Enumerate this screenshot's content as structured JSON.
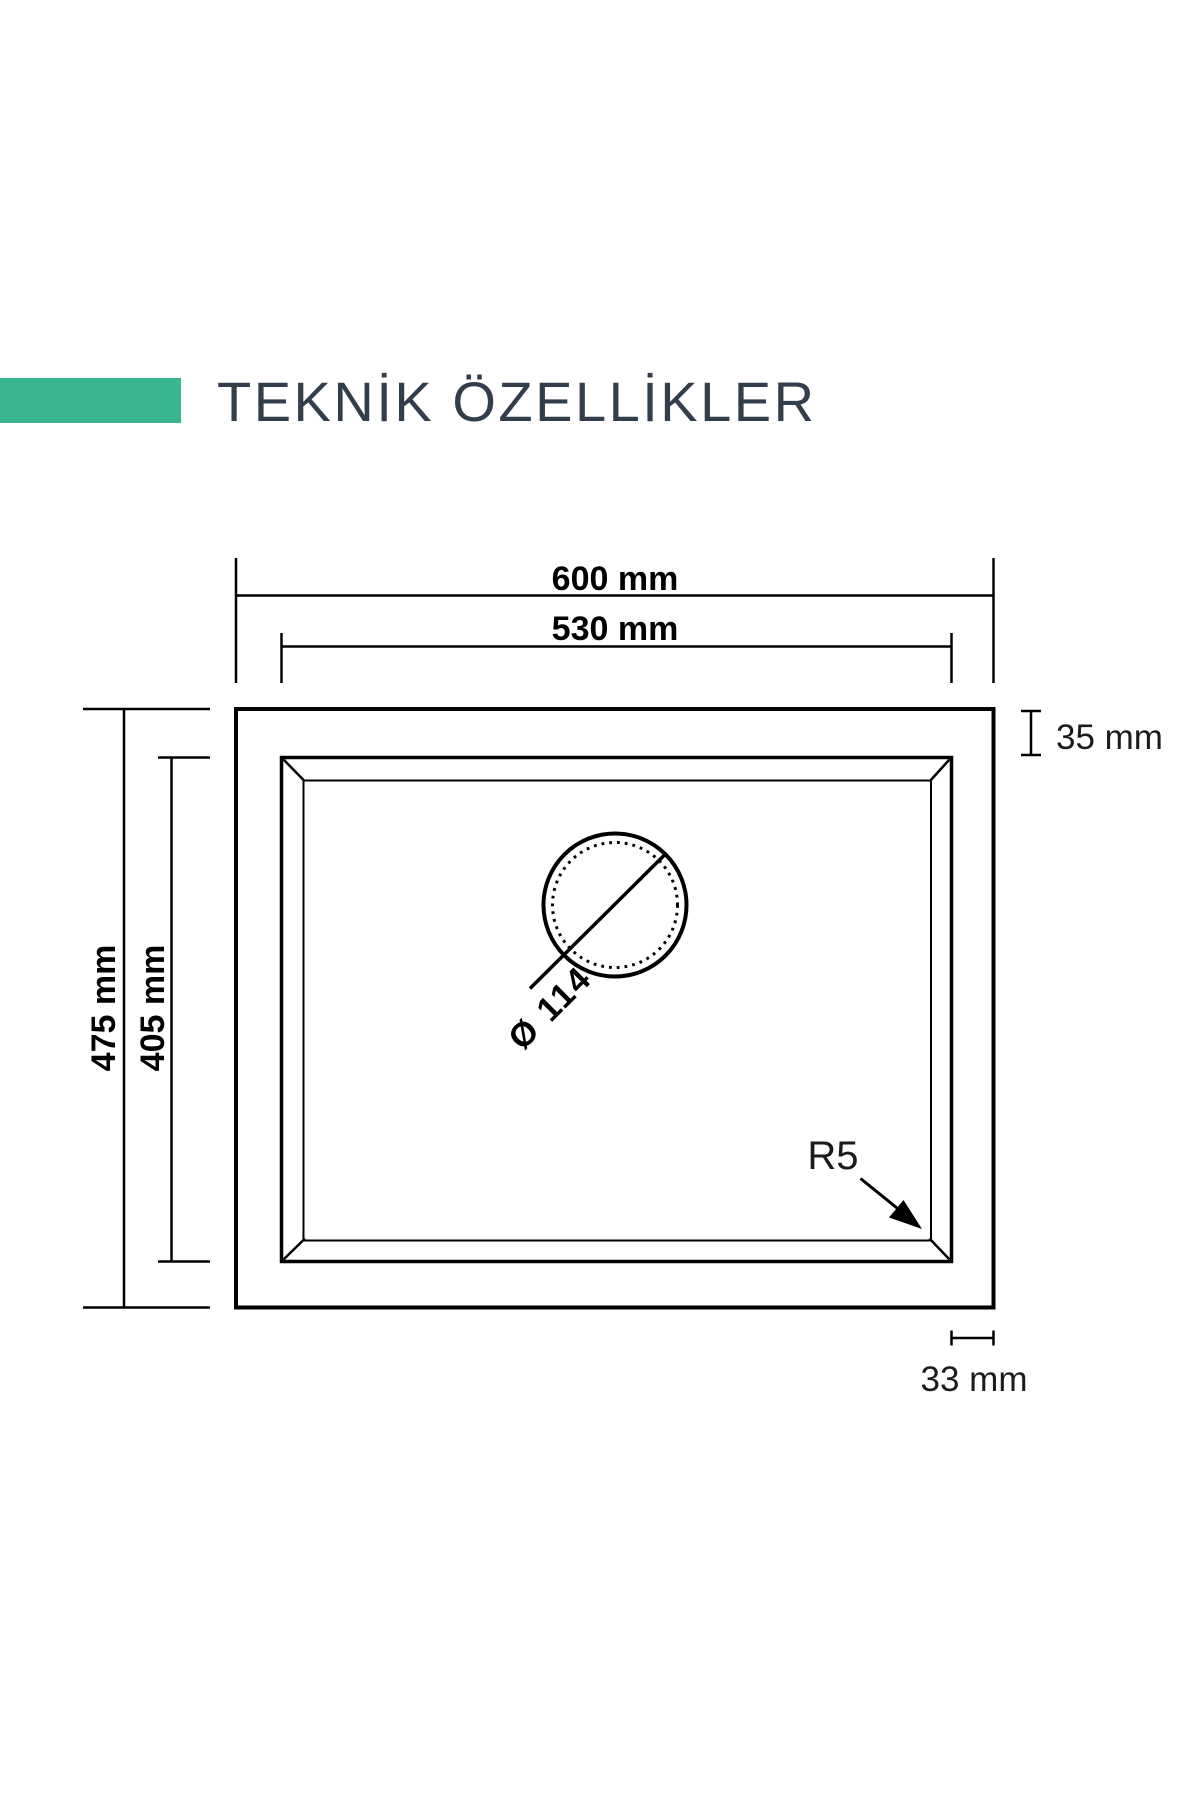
{
  "title": {
    "text": "TEKNİK ÖZELLİKLER"
  },
  "colors": {
    "accent": "#3ab592",
    "ink": "#333e4d",
    "line": "#000000"
  },
  "diagram": {
    "labels": {
      "outer_width": "600 mm",
      "inner_width": "530 mm",
      "outer_depth": "475 mm",
      "inner_depth": "405 mm",
      "rim_top": "35 mm",
      "rim_side": "33 mm",
      "drain_diameter": "Ø 114",
      "corner_radius": "R5"
    }
  }
}
